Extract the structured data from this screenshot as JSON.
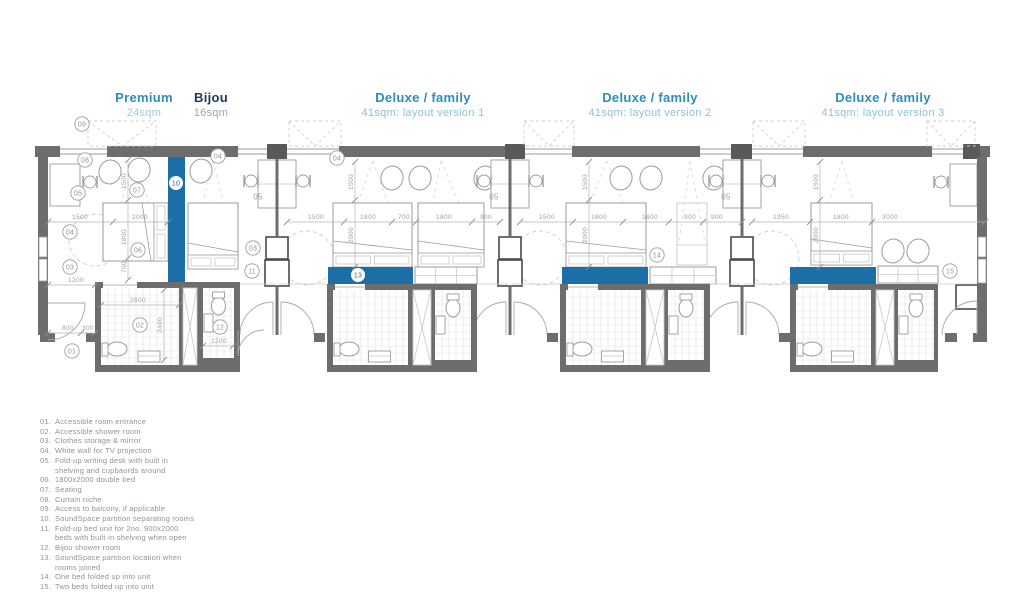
{
  "header": {
    "columns": [
      {
        "title": "Premium",
        "subtitle": "24sqm",
        "title_color": "#2d8dbc",
        "subtitle_color": "#a5c8d9",
        "cx": 144
      },
      {
        "title": "Bijou",
        "subtitle": "16sqm",
        "title_color": "#16395f",
        "subtitle_color": "#9ba6ae",
        "cx": 211
      },
      {
        "title": "Deluxe / family",
        "subtitle": "41sqm: layout version 1",
        "title_color": "#2d8dbc",
        "subtitle_color": "#8fc0d8",
        "cx": 423
      },
      {
        "title": "Deluxe / family",
        "subtitle": "41sqm: layout version 2",
        "title_color": "#2d8dbc",
        "subtitle_color": "#8fc0d8",
        "cx": 650
      },
      {
        "title": "Deluxe / family",
        "subtitle": "41sqm: layout version 3",
        "title_color": "#2d8dbc",
        "subtitle_color": "#8fc0d8",
        "cx": 883
      }
    ]
  },
  "legend": {
    "items": [
      {
        "num": "01.",
        "text": "Accessible room entrance"
      },
      {
        "num": "02.",
        "text": "Accessible shower room"
      },
      {
        "num": "03.",
        "text": "Clothes storage & mirror"
      },
      {
        "num": "04.",
        "text": "White wall for TV projection"
      },
      {
        "num": "05.",
        "text": "Fold-up writing desk with built in\nshelving and cupbaords around"
      },
      {
        "num": "06.",
        "text": "1800x2000 double bed"
      },
      {
        "num": "07.",
        "text": "Seating"
      },
      {
        "num": "08.",
        "text": "Curtain niche"
      },
      {
        "num": "09.",
        "text": "Access to balcony, if applicable"
      },
      {
        "num": "10.",
        "text": "SoundSpace partition separating rooms"
      },
      {
        "num": "11.",
        "text": "Fold-up bed unit for 2no. 900x2000\nbeds with built-in shelving when open"
      },
      {
        "num": "12.",
        "text": "Bijou shower room"
      },
      {
        "num": "13.",
        "text": "SoundSpace partition location when\nrooms joined"
      },
      {
        "num": "14.",
        "text": "One bed folded up into unit"
      },
      {
        "num": "15.",
        "text": "Two beds folded up into unit"
      }
    ]
  },
  "plan": {
    "colors": {
      "wall": "#6d6d6d",
      "column": "#595959",
      "blue": "#1b6fa6",
      "line": "#9b9b9b",
      "light": "#c9c9c9",
      "dash": "#cfcfcf",
      "tan": "#e6dcc0",
      "tile": "#e2e2e2",
      "dimtext": "#98a1a8",
      "marker": "#9aa0a6"
    },
    "top_wall": {
      "y": 146,
      "h": 11,
      "col_y": 144,
      "col_h": 15,
      "segments": [
        {
          "x": 35,
          "w": 25,
          "t": "wall"
        },
        {
          "x": 60,
          "w": 47,
          "t": "win"
        },
        {
          "x": 107,
          "w": 131,
          "t": "wall"
        },
        {
          "x": 238,
          "w": 29,
          "t": "win"
        },
        {
          "x": 267,
          "w": 20,
          "t": "col"
        },
        {
          "x": 287,
          "w": 52,
          "t": "win"
        },
        {
          "x": 339,
          "w": 166,
          "t": "wall"
        },
        {
          "x": 505,
          "w": 20,
          "t": "col"
        },
        {
          "x": 525,
          "w": 47,
          "t": "win"
        },
        {
          "x": 572,
          "w": 128,
          "t": "wall"
        },
        {
          "x": 700,
          "w": 31,
          "t": "win"
        },
        {
          "x": 731,
          "w": 21,
          "t": "col"
        },
        {
          "x": 752,
          "w": 51,
          "t": "win"
        },
        {
          "x": 803,
          "w": 129,
          "t": "wall"
        },
        {
          "x": 932,
          "w": 31,
          "t": "win"
        },
        {
          "x": 963,
          "w": 17,
          "t": "col"
        },
        {
          "x": 980,
          "w": 10,
          "t": "wall"
        }
      ]
    },
    "balconies": {
      "y": 121,
      "h": 25,
      "list": [
        {
          "x": 88,
          "w": 68
        },
        {
          "x": 289,
          "w": 52
        },
        {
          "x": 524,
          "w": 50
        },
        {
          "x": 753,
          "w": 52
        },
        {
          "x": 927,
          "w": 48
        }
      ]
    },
    "ext_walls": {
      "left": {
        "x": 38,
        "y": 157,
        "w": 10,
        "h": 178,
        "windows": [
          [
            237,
            20
          ],
          [
            259,
            22
          ]
        ]
      },
      "right": {
        "x": 977,
        "y": 157,
        "w": 10,
        "h": 178,
        "windows": [
          [
            237,
            20
          ],
          [
            259,
            24
          ]
        ]
      }
    },
    "party_walls": [
      {
        "cx": 277
      },
      {
        "cx": 510
      },
      {
        "cx": 742
      }
    ],
    "extra_desks": [
      {
        "x": 50,
        "y": 164,
        "w": 30,
        "h": 42,
        "chair": [
          90,
          182
        ]
      },
      {
        "x": 950,
        "y": 164,
        "w": 27,
        "h": 42,
        "chair": [
          941,
          182
        ]
      }
    ],
    "right_storage": {
      "x": 956,
      "y": 285,
      "w": 22,
      "h": 24
    },
    "blue_partitions": [
      {
        "x": 168,
        "y": 152,
        "w": 17,
        "h": 130
      },
      {
        "x": 328,
        "y": 267,
        "w": 85,
        "h": 17
      },
      {
        "x": 562,
        "y": 267,
        "w": 86,
        "h": 17
      },
      {
        "x": 790,
        "y": 267,
        "w": 86,
        "h": 17
      }
    ],
    "beds": [
      {
        "x": 103,
        "y": 203,
        "w": 65,
        "h": 58,
        "head": "right"
      },
      {
        "x": 188,
        "y": 203,
        "w": 50,
        "h": 66,
        "head": "bottom"
      },
      {
        "x": 333,
        "y": 203,
        "w": 79,
        "h": 64,
        "head": "bottom"
      },
      {
        "x": 418,
        "y": 203,
        "w": 66,
        "h": 64,
        "head": "bottom"
      },
      {
        "x": 566,
        "y": 203,
        "w": 80,
        "h": 64,
        "head": "bottom"
      },
      {
        "x": 811,
        "y": 203,
        "w": 61,
        "h": 62,
        "head": "bottom"
      }
    ],
    "ghost_bed": {
      "x": 677,
      "y": 203,
      "w": 30,
      "h": 62
    },
    "fold_units": [
      {
        "x": 415,
        "y": 267,
        "w": 62,
        "h": 17
      },
      {
        "x": 650,
        "y": 267,
        "w": 66,
        "h": 17
      },
      {
        "x": 878,
        "y": 266,
        "w": 60,
        "h": 17
      }
    ],
    "pebbles": [
      [
        110,
        172
      ],
      [
        139,
        170
      ],
      [
        201,
        171
      ],
      [
        392,
        178
      ],
      [
        420,
        178
      ],
      [
        485,
        178
      ],
      [
        621,
        178
      ],
      [
        651,
        178
      ],
      [
        714,
        178
      ],
      [
        893,
        251
      ],
      [
        918,
        251
      ]
    ],
    "showers": [
      {
        "ox": 95,
        "oy": 282,
        "ow": 145,
        "oh": 90,
        "big": [
          101,
          179
        ],
        "duct": [
          183,
          197
        ],
        "small": [
          203,
          234
        ],
        "small_bottom": 358,
        "door_gap": [
          103,
          137
        ]
      },
      {
        "ox": 327,
        "oy": 284,
        "ow": 150,
        "oh": 88,
        "big": [
          333,
          408
        ],
        "duct": [
          413,
          431
        ],
        "small": [
          435,
          471
        ],
        "small_bottom": 360,
        "door_gap": [
          335,
          365
        ]
      },
      {
        "ox": 560,
        "oy": 284,
        "ow": 150,
        "oh": 88,
        "big": [
          566,
          641
        ],
        "duct": [
          646,
          664
        ],
        "small": [
          668,
          704
        ],
        "small_bottom": 360,
        "door_gap": [
          568,
          598
        ]
      },
      {
        "ox": 790,
        "oy": 284,
        "ow": 148,
        "oh": 88,
        "big": [
          796,
          871
        ],
        "duct": [
          876,
          894
        ],
        "small": [
          898,
          934
        ],
        "small_bottom": 360,
        "door_gap": [
          798,
          828
        ]
      }
    ],
    "corridor_lines": [
      [
        240,
        284,
        275,
        284
      ],
      [
        279,
        284,
        327,
        284
      ],
      [
        477,
        284,
        508,
        284
      ],
      [
        512,
        284,
        560,
        284
      ],
      [
        710,
        284,
        740,
        284
      ],
      [
        744,
        284,
        790,
        284
      ],
      [
        938,
        284,
        977,
        284
      ]
    ],
    "end_doors": {
      "left": {
        "leaf": [
          48,
          303,
          85,
          303
        ],
        "arc": "M 85 303 A 37 37 0 0 1 48 340"
      },
      "right": {
        "leaf": [
          977,
          301,
          977,
          335
        ],
        "arc": "M 942 335 A 35 35 0 0 1 977 301"
      },
      "bijou": {
        "leaf": [
          238,
          330,
          238,
          356
        ],
        "arc": "M 238 356 A 26 26 0 0 1 264 330"
      }
    },
    "bottom_stubs": [
      [
        40,
        333,
        15,
        9
      ],
      [
        86,
        333,
        9,
        9
      ],
      [
        945,
        333,
        12,
        9
      ],
      [
        973,
        333,
        14,
        9
      ]
    ],
    "fans": [
      {
        "a": [
          135,
          161
        ],
        "l": [
          106,
          248
        ],
        "r": [
          162,
          243
        ]
      },
      {
        "a": [
          213,
          161
        ],
        "l": [
          191,
          252
        ],
        "r": [
          236,
          252
        ]
      },
      {
        "a": [
          373,
          161
        ],
        "l": [
          341,
          248
        ],
        "r": [
          404,
          248
        ]
      },
      {
        "a": [
          441,
          161
        ],
        "l": [
          424,
          248
        ],
        "r": [
          478,
          248
        ]
      },
      {
        "a": [
          607,
          161
        ],
        "l": [
          571,
          248
        ],
        "r": [
          640,
          248
        ]
      },
      {
        "a": [
          690,
          161
        ],
        "l": [
          679,
          243
        ],
        "r": [
          705,
          243
        ]
      },
      {
        "a": [
          842,
          161
        ],
        "l": [
          815,
          246
        ],
        "r": [
          866,
          246
        ]
      }
    ],
    "dash_circles": [
      {
        "x": 95,
        "y": 240,
        "r": 26
      },
      {
        "x": 140,
        "y": 326,
        "r": 21
      },
      {
        "x": 307,
        "y": 258,
        "r": 27
      },
      {
        "x": 370,
        "y": 326,
        "r": 21
      },
      {
        "x": 540,
        "y": 258,
        "r": 27
      },
      {
        "x": 603,
        "y": 326,
        "r": 21
      },
      {
        "x": 772,
        "y": 258,
        "r": 27
      },
      {
        "x": 833,
        "y": 326,
        "r": 21
      }
    ],
    "dims_h": [
      {
        "y": 219,
        "x1": 48,
        "x2": 168,
        "ticks": [
          48,
          113,
          168
        ],
        "labels": [
          {
            "t": "1500",
            "x": 80
          },
          {
            "t": "2000",
            "x": 140
          }
        ]
      },
      {
        "y": 219,
        "x1": 287,
        "x2": 500,
        "ticks": [
          287,
          344,
          392,
          416,
          472,
          500
        ],
        "labels": [
          {
            "t": "1500",
            "x": 316
          },
          {
            "t": "1800",
            "x": 368
          },
          {
            "t": "700",
            "x": 404
          },
          {
            "t": "1800",
            "x": 444
          },
          {
            "t": "900",
            "x": 486
          }
        ]
      },
      {
        "y": 219,
        "x1": 520,
        "x2": 742,
        "ticks": [
          520,
          573,
          623,
          669,
          703,
          742
        ],
        "labels": [
          {
            "t": "1500",
            "x": 547
          },
          {
            "t": "1800",
            "x": 599
          },
          {
            "t": "1600",
            "x": 650
          },
          {
            "t": "900",
            "x": 690
          },
          {
            "t": "900",
            "x": 717
          }
        ]
      },
      {
        "y": 219,
        "x1": 752,
        "x2": 985,
        "ticks": [
          752,
          810,
          872,
          985
        ],
        "labels": [
          {
            "t": "1950",
            "x": 781
          },
          {
            "t": "1800",
            "x": 841
          },
          {
            "t": "3000",
            "x": 890
          }
        ]
      },
      {
        "y": 282,
        "x1": 48,
        "x2": 95,
        "ticks": [
          48,
          95
        ],
        "labels": [
          {
            "t": "1200",
            "x": 76
          }
        ]
      },
      {
        "y": 302,
        "x1": 101,
        "x2": 179,
        "ticks": [
          101,
          179
        ],
        "labels": [
          {
            "t": "2600",
            "x": 138
          }
        ]
      },
      {
        "y": 330,
        "x1": 48,
        "x2": 95,
        "ticks": [
          48,
          81,
          95
        ],
        "labels": [
          {
            "t": "800",
            "x": 68
          },
          {
            "t": "300",
            "x": 88
          }
        ]
      },
      {
        "y": 343,
        "x1": 203,
        "x2": 233,
        "ticks": [
          203,
          233
        ],
        "labels": [
          {
            "t": "1200",
            "x": 219
          }
        ]
      }
    ],
    "dims_v": [
      {
        "x": 128,
        "y1": 160,
        "y2": 280,
        "ticks": [
          160,
          200,
          258,
          280
        ],
        "labels": [
          {
            "t": "1500",
            "y": 181
          },
          {
            "t": "1800",
            "y": 237
          },
          {
            "t": "700",
            "y": 267
          }
        ]
      },
      {
        "x": 355,
        "y1": 162,
        "y2": 267,
        "ticks": [
          162,
          200,
          267
        ],
        "labels": [
          {
            "t": "1500",
            "y": 182
          },
          {
            "t": "2000",
            "y": 235
          }
        ]
      },
      {
        "x": 589,
        "y1": 162,
        "y2": 267,
        "ticks": [
          162,
          200,
          267
        ],
        "labels": [
          {
            "t": "1500",
            "y": 182
          },
          {
            "t": "2000",
            "y": 235
          }
        ]
      },
      {
        "x": 820,
        "y1": 162,
        "y2": 267,
        "ticks": [
          162,
          200,
          267
        ],
        "labels": [
          {
            "t": "1500",
            "y": 182
          },
          {
            "t": "2000",
            "y": 235
          }
        ]
      },
      {
        "x": 164,
        "y1": 290,
        "y2": 360,
        "ticks": [
          290,
          360
        ],
        "labels": [
          {
            "t": "2400",
            "y": 325
          }
        ]
      }
    ],
    "markers": [
      {
        "t": "09",
        "x": 82,
        "y": 124,
        "s": "g"
      },
      {
        "t": "08",
        "x": 85,
        "y": 160,
        "s": "g"
      },
      {
        "t": "05",
        "x": 78,
        "y": 193,
        "s": "g"
      },
      {
        "t": "04",
        "x": 70,
        "y": 232,
        "s": "g"
      },
      {
        "t": "03",
        "x": 70,
        "y": 267,
        "s": "g"
      },
      {
        "t": "01",
        "x": 72,
        "y": 351,
        "s": "g"
      },
      {
        "t": "07",
        "x": 137,
        "y": 190,
        "s": "g"
      },
      {
        "t": "06",
        "x": 138,
        "y": 250,
        "s": "g"
      },
      {
        "t": "10",
        "x": 176,
        "y": 183,
        "s": "b"
      },
      {
        "t": "04",
        "x": 218,
        "y": 156,
        "s": "g"
      },
      {
        "t": "02",
        "x": 140,
        "y": 325,
        "s": "g"
      },
      {
        "t": "12",
        "x": 220,
        "y": 327,
        "s": "g"
      },
      {
        "t": "05",
        "x": 258,
        "y": 197,
        "s": "p"
      },
      {
        "t": "03",
        "x": 253,
        "y": 248,
        "s": "g"
      },
      {
        "t": "11",
        "x": 252,
        "y": 271,
        "s": "g"
      },
      {
        "t": "04",
        "x": 337,
        "y": 158,
        "s": "g"
      },
      {
        "t": "13",
        "x": 358,
        "y": 275,
        "s": "b"
      },
      {
        "t": "05",
        "x": 494,
        "y": 197,
        "s": "p"
      },
      {
        "t": "14",
        "x": 657,
        "y": 255,
        "s": "g"
      },
      {
        "t": "05",
        "x": 726,
        "y": 197,
        "s": "p"
      },
      {
        "t": "15",
        "x": 950,
        "y": 271,
        "s": "g"
      }
    ]
  }
}
